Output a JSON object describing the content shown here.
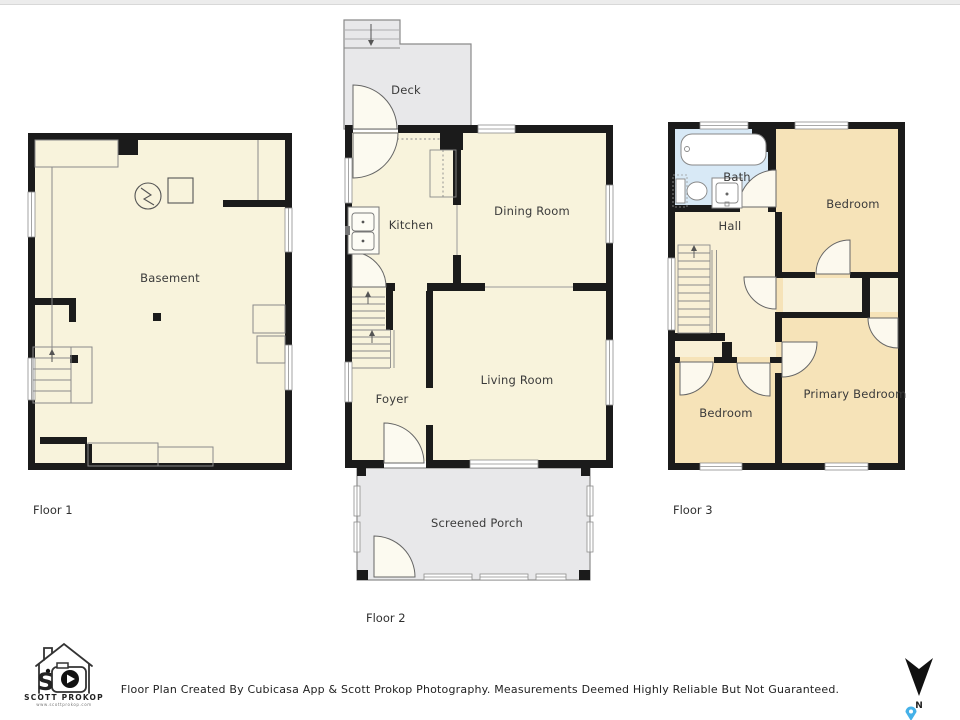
{
  "page": {
    "footer_text": "Floor Plan Created By Cubicasa App & Scott Prokop Photography. Measurements Deemed Highly Reliable But Not Guaranteed."
  },
  "branding": {
    "monogram": "S",
    "name": "SCOTT PROKOP",
    "url": "www.scottprokop.com"
  },
  "compass": {
    "label": "N"
  },
  "colors": {
    "wall": "#1b1b1b",
    "room_cream": "#f8f3dc",
    "hall_cream": "#f9f0d6",
    "room_tan": "#f6e3b8",
    "bath_blue": "#d8e9f6",
    "outdoor_gray": "#e8e8ea",
    "door_stroke": "#666666",
    "pin_blue": "#45b1e8"
  },
  "floors": [
    {
      "caption": "Floor 1",
      "rooms": [
        {
          "label": "Basement"
        }
      ]
    },
    {
      "caption": "Floor 2",
      "rooms": [
        {
          "label": "Deck"
        },
        {
          "label": "Kitchen"
        },
        {
          "label": "Dining Room"
        },
        {
          "label": "Living Room"
        },
        {
          "label": "Foyer"
        },
        {
          "label": "Screened Porch"
        }
      ]
    },
    {
      "caption": "Floor 3",
      "rooms": [
        {
          "label": "Bath"
        },
        {
          "label": "Hall"
        },
        {
          "label": "Bedroom"
        },
        {
          "label": "Bedroom"
        },
        {
          "label": "Primary Bedroom"
        }
      ]
    }
  ]
}
